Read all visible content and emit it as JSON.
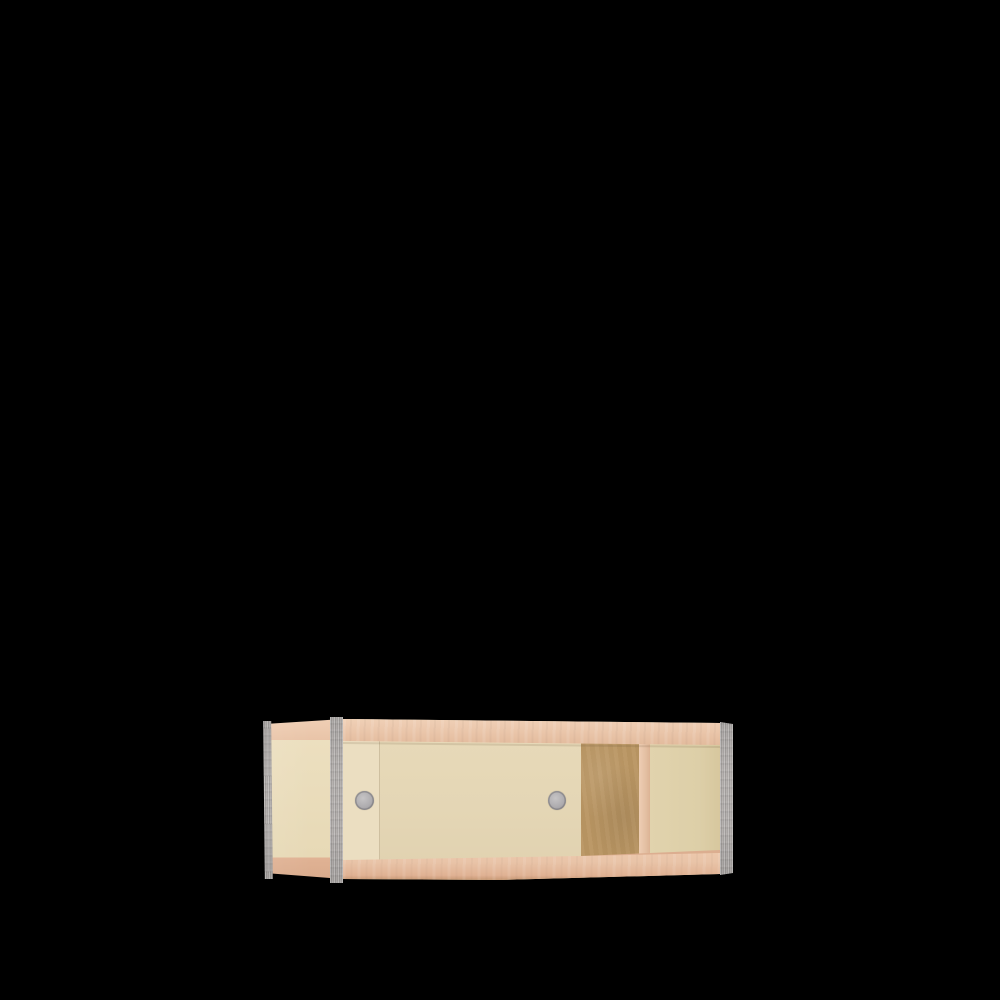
{
  "scene": {
    "type": "3d-product-render",
    "object": "low plywood cabinet with sliding doors, wall-hung, viewed from front-left",
    "background": "#000000"
  },
  "colors": {
    "background": "#000000",
    "rail_light": "#f0d0b6",
    "rail": "#e9c4a8",
    "rail_dark": "#e0b294",
    "door_cream": "#e4d6b5",
    "door_cream_light": "#ebdec1",
    "side_cream": "#ecdfbf",
    "recessed_cream": "#ddcfa8",
    "back_brown": "#ba9663",
    "divider_pink": "#e2bda0",
    "floor_pink": "#dcae90",
    "edge_gray": "#b3afad",
    "handle_gray": "#aeacaf"
  },
  "parts": {
    "left_side_panel": "Left side panel",
    "top_rail": "Top rail",
    "bottom_rail": "Bottom rail",
    "rear_door": "Rear sliding door (narrow visible strip)",
    "front_door": "Front sliding door",
    "finger_pull_left": "Round metal finger pull, rear door",
    "finger_pull_right": "Round metal finger pull, front door",
    "back_panel": "Exposed brown back panel (open bay)",
    "divider": "Vertical divider front edge",
    "recessed_panel": "Recessed rear panel, right bay",
    "interior_floor": "Interior bottom shelf surface",
    "edge_rear_left": "Rear-left metal edge trim",
    "edge_front_left": "Front-left metal edge trim",
    "edge_front_right": "Front-right metal edge trim"
  }
}
